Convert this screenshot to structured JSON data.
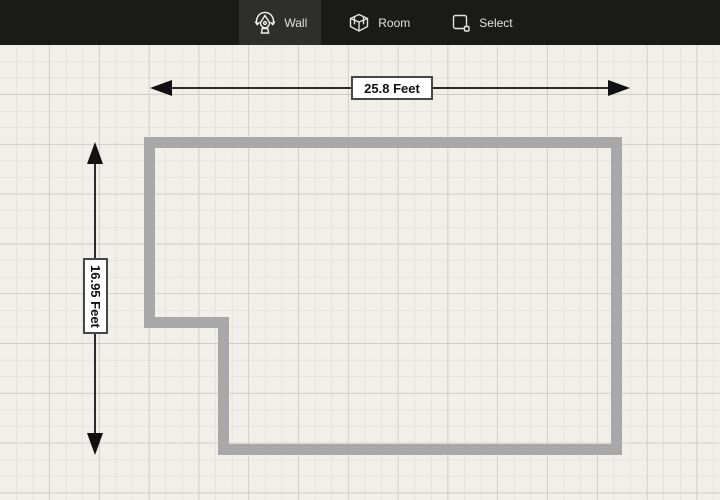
{
  "toolbar": {
    "tools": [
      {
        "id": "wall",
        "label": "Wall",
        "active": true,
        "icon": "pen-nib-rotate-icon"
      },
      {
        "id": "room",
        "label": "Room",
        "active": false,
        "icon": "room-box-3d-icon"
      },
      {
        "id": "select",
        "label": "Select",
        "active": false,
        "icon": "select-marquee-icon"
      }
    ]
  },
  "canvas": {
    "dimensions": {
      "horizontal": {
        "label": "25.8 Feet"
      },
      "vertical": {
        "label": "16.95 Feet"
      }
    },
    "colors": {
      "toolbar_bg": "#1a1a18",
      "active_tool_bg": "#2e2e2c",
      "tool_text": "#e2e2e2",
      "canvas_bg": "#f0efea",
      "grid_minor": "#dad8d2",
      "grid_major": "#c1bfb9",
      "wall": "#a8a8a8",
      "dimension_line": "#2b2b2b",
      "label_border": "#474747",
      "label_bg": "#ffffff"
    }
  }
}
